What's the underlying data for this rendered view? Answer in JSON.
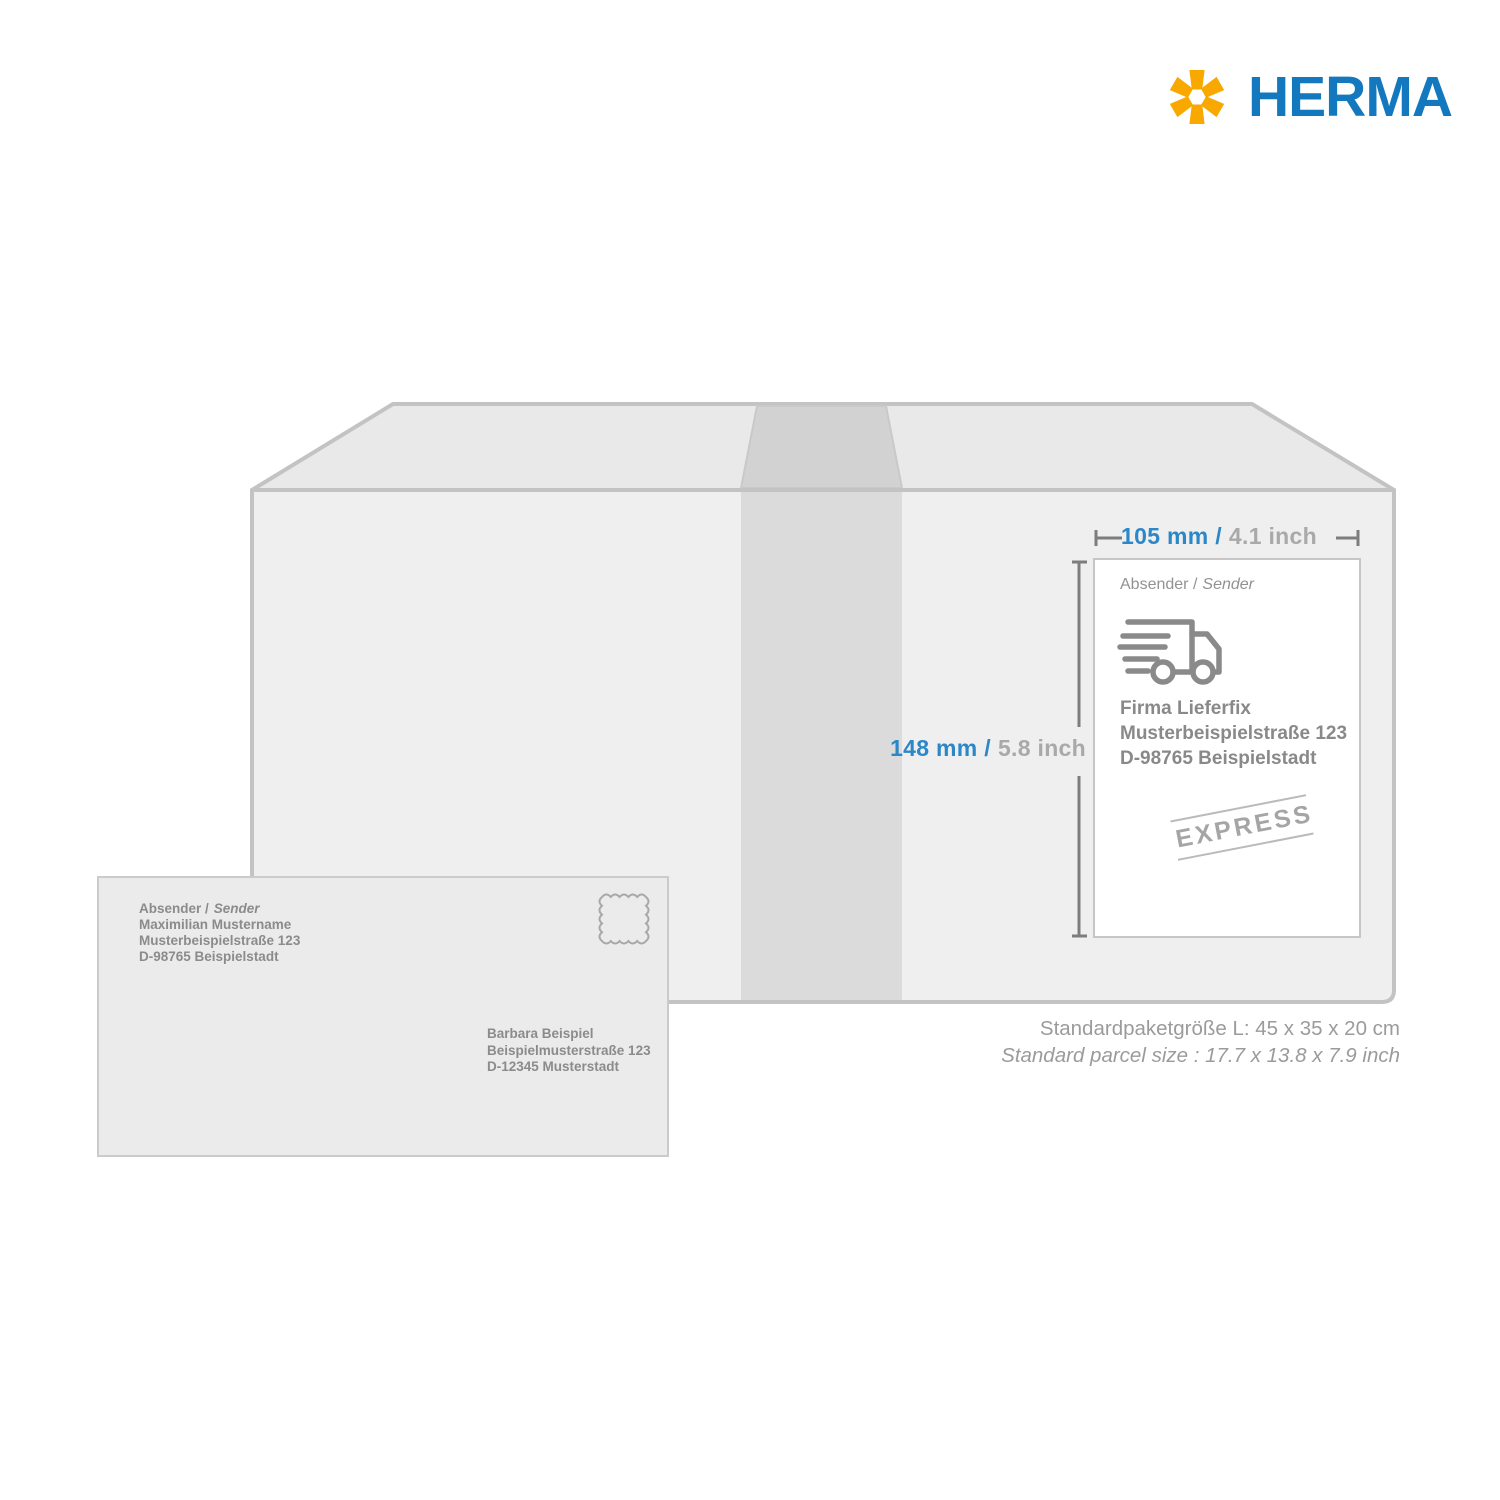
{
  "brand": {
    "name": "HERMA"
  },
  "colors": {
    "brand_blue": "#1478bf",
    "brand_yellow": "#f9a800",
    "dimension_blue": "#2b87c8",
    "dimension_gray": "#a9a9a9",
    "text_gray": "#8b8b8b",
    "box_face": "#efefef",
    "box_top": "#e9e9e9",
    "tape": "#dbdbdb"
  },
  "icons": {
    "logo_mark": "six-arm-asterisk",
    "label_icon": "fast-delivery-truck",
    "envelope_icon": "postage-stamp-outline"
  },
  "dimensions": {
    "width_mm": "105 mm /",
    "width_inch": "4.1 inch",
    "height_mm": "148 mm /",
    "height_inch": "5.8 inch"
  },
  "package_label": {
    "sender_label": "Absender /",
    "sender_label_en": "Sender",
    "address": [
      "Firma Lieferfix",
      "Musterbeispielstraße 123",
      "D-98765 Beispielstadt"
    ],
    "stamp": "EXPRESS"
  },
  "parcel_info": {
    "line_de": "Standardpaketgröße L: 45 x 35 x 20 cm",
    "line_en": "Standard parcel size : 17.7 x 13.8 x 7.9 inch"
  },
  "envelope": {
    "sender_label": "Absender /",
    "sender_label_en": "Sender",
    "sender": [
      "Maximilian Mustername",
      "Musterbeispielstraße 123",
      "D-98765 Beispielstadt"
    ],
    "recipient": [
      "Barbara Beispiel",
      "Beispielmusterstraße 123",
      "D-12345 Musterstadt"
    ]
  }
}
